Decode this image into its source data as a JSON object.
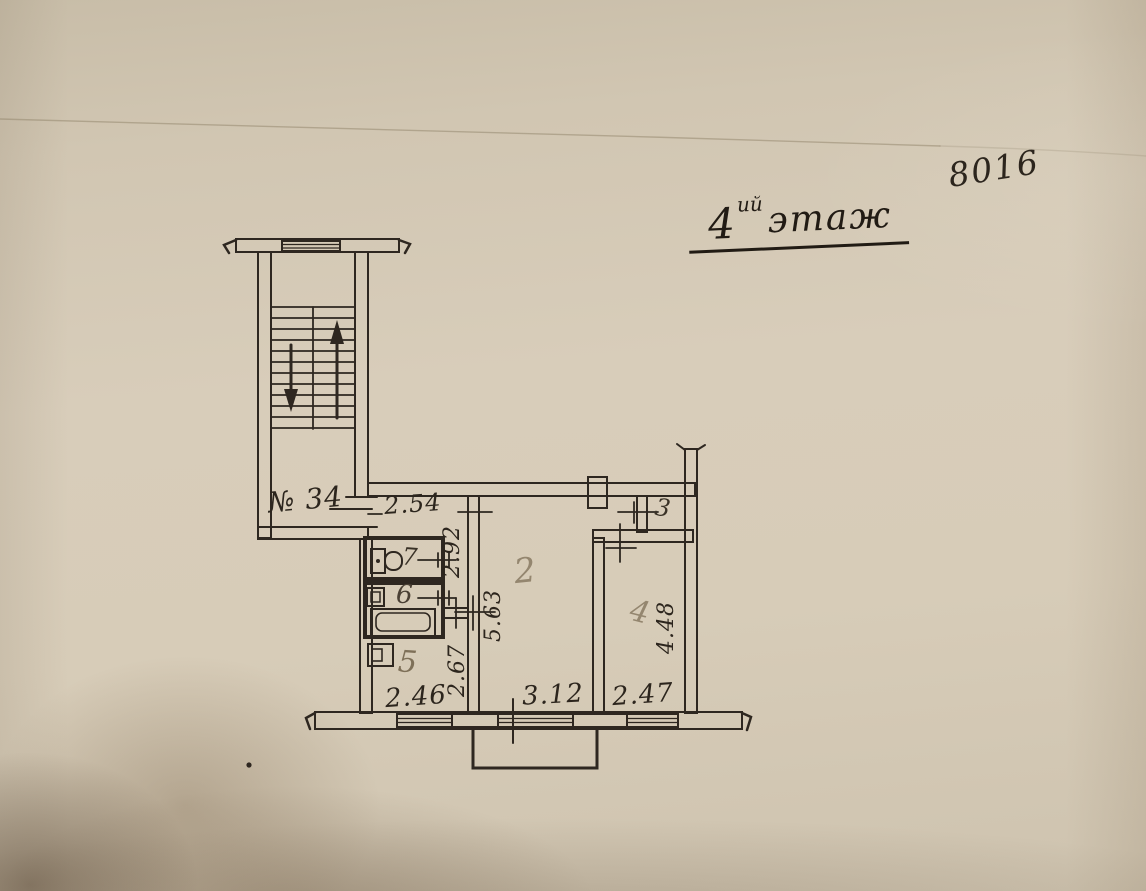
{
  "document": {
    "archive_code": "8016",
    "title": {
      "floor_number": "4",
      "floor_suffix": "ий",
      "floor_word": "этаж"
    },
    "apartment_number": "№ 34"
  },
  "rooms": {
    "room2": {
      "label": "2"
    },
    "room3": {
      "label": "3"
    },
    "room4": {
      "label": "4"
    },
    "room5": {
      "label": "5"
    },
    "room6": {
      "label": "6"
    },
    "room7": {
      "label": "7"
    }
  },
  "dimensions": {
    "hallway_width": "2.54",
    "corridor_length": "2.92",
    "room2_depth": "5.63",
    "room2_width": "3.12",
    "kitchen_depth": "2.67",
    "kitchen_width": "2.46",
    "room4_depth": "4.48",
    "room4_width": "2.47"
  },
  "colors": {
    "ink": "#2e2720",
    "pencil": "#94866f",
    "paper": "#d6cbb8",
    "shadow": "#6d5840"
  }
}
